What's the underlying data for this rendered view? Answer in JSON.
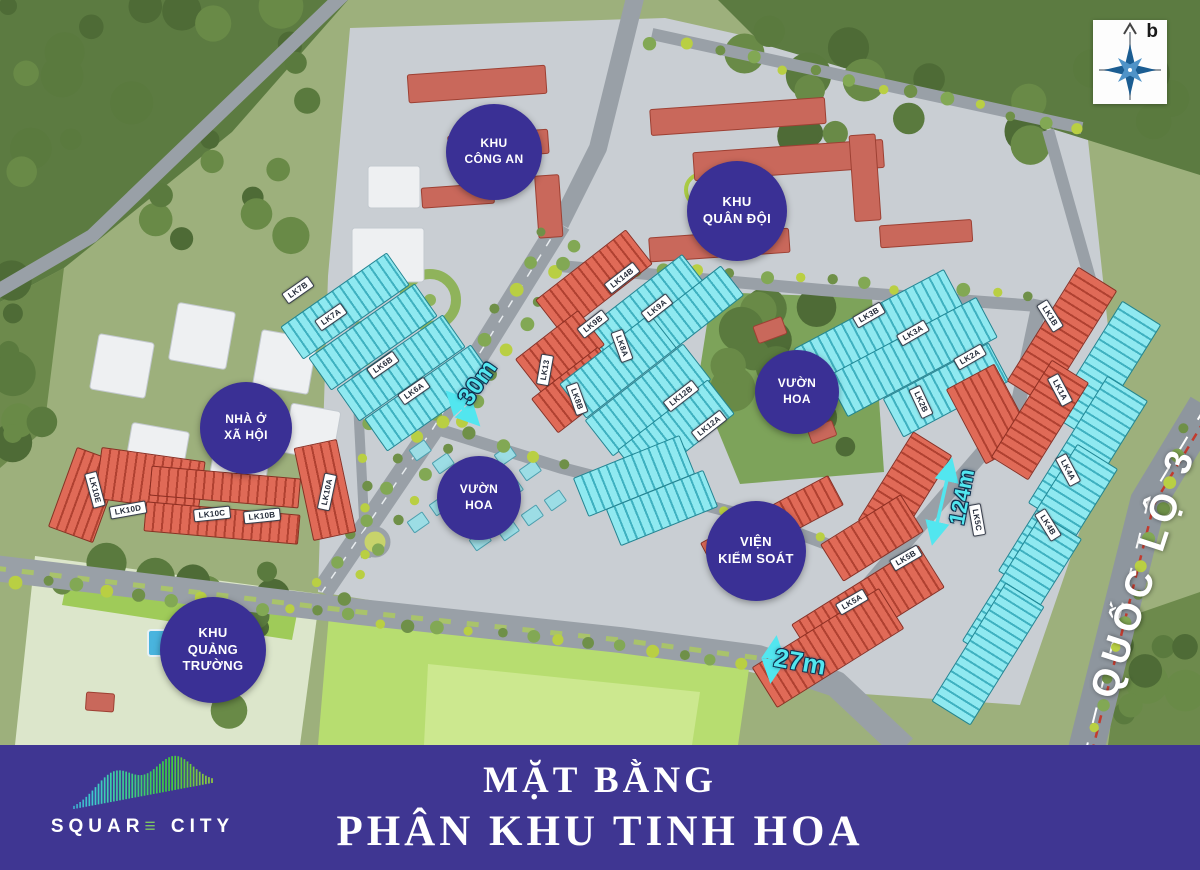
{
  "poster": {
    "banner": {
      "title_line1": "MẶT BẰNG",
      "title_line2": "PHÂN KHU TINH HOA"
    },
    "logo": {
      "name": "SQUARE CITY",
      "before_e": "SQUAR",
      "e_glyph": "≡",
      "after_e": " CITY"
    },
    "compass": {
      "label": "b"
    }
  },
  "map": {
    "colors": {
      "badge": "#3a3095",
      "banner": "#3f3692",
      "cyan_block": "#8fe9f0",
      "red_block": "#e06a57",
      "road_label": "#52e6ef"
    },
    "area_badges": [
      {
        "id": "khu-cong-an",
        "lines": [
          "KHU",
          "CÔNG AN"
        ],
        "x": 494,
        "y": 152,
        "d": 96
      },
      {
        "id": "khu-quan-doi",
        "lines": [
          "KHU",
          "QUÂN ĐỘI"
        ],
        "x": 737,
        "y": 211,
        "d": 100
      },
      {
        "id": "nha-o-xa-hoi",
        "lines": [
          "NHÀ Ở",
          "XÃ HỘI"
        ],
        "x": 246,
        "y": 428,
        "d": 92
      },
      {
        "id": "vuon-hoa-west",
        "lines": [
          "VƯỜN",
          "HOA"
        ],
        "x": 479,
        "y": 498,
        "d": 84
      },
      {
        "id": "vuon-hoa-east",
        "lines": [
          "VƯỜN",
          "HOA"
        ],
        "x": 797,
        "y": 392,
        "d": 84
      },
      {
        "id": "vien-kiem-soat",
        "lines": [
          "VIỆN",
          "KIỂM SOÁT"
        ],
        "x": 756,
        "y": 551,
        "d": 100
      },
      {
        "id": "khu-quang-truong",
        "lines": [
          "KHU",
          "QUẢNG",
          "TRƯỜNG"
        ],
        "x": 213,
        "y": 650,
        "d": 106
      }
    ],
    "road_labels": [
      {
        "id": "road-30m",
        "text": "30m",
        "x": 478,
        "y": 383,
        "rot": -55,
        "size": 24,
        "style": "cyan"
      },
      {
        "id": "road-27m",
        "text": "27m",
        "x": 800,
        "y": 662,
        "rot": 10,
        "size": 26,
        "style": "cyan"
      },
      {
        "id": "road-124m",
        "text": "124m",
        "x": 962,
        "y": 497,
        "rot": -79,
        "size": 22,
        "style": "cyan"
      },
      {
        "id": "highway-quoc-lo-3",
        "text": "QUỐC LỘ 3",
        "x": 1144,
        "y": 572,
        "rot": -72,
        "size": 38,
        "style": "white"
      }
    ],
    "block_labels": [
      {
        "code": "LK10E",
        "x": 95,
        "y": 490,
        "rot": 75
      },
      {
        "code": "LK10D",
        "x": 128,
        "y": 510,
        "rot": -10
      },
      {
        "code": "LK10C",
        "x": 212,
        "y": 514,
        "rot": -6
      },
      {
        "code": "LK10B",
        "x": 262,
        "y": 516,
        "rot": -6
      },
      {
        "code": "LK10A",
        "x": 327,
        "y": 492,
        "rot": -78
      },
      {
        "code": "LK7B",
        "x": 298,
        "y": 290,
        "rot": -35
      },
      {
        "code": "LK7A",
        "x": 331,
        "y": 317,
        "rot": -35
      },
      {
        "code": "LK6B",
        "x": 383,
        "y": 365,
        "rot": -35
      },
      {
        "code": "LK6A",
        "x": 414,
        "y": 391,
        "rot": -35
      },
      {
        "code": "LK9B",
        "x": 593,
        "y": 324,
        "rot": -38
      },
      {
        "code": "LK9A",
        "x": 657,
        "y": 308,
        "rot": -38
      },
      {
        "code": "LK14B",
        "x": 622,
        "y": 278,
        "rot": -38
      },
      {
        "code": "LK13",
        "x": 545,
        "y": 370,
        "rot": -80
      },
      {
        "code": "LK8A",
        "x": 622,
        "y": 346,
        "rot": 70
      },
      {
        "code": "LK8B",
        "x": 577,
        "y": 399,
        "rot": 70
      },
      {
        "code": "LK12B",
        "x": 681,
        "y": 396,
        "rot": -38
      },
      {
        "code": "LK12A",
        "x": 709,
        "y": 426,
        "rot": -38
      },
      {
        "code": "LK3B",
        "x": 869,
        "y": 315,
        "rot": -30
      },
      {
        "code": "LK3A",
        "x": 913,
        "y": 333,
        "rot": -30
      },
      {
        "code": "LK2A",
        "x": 970,
        "y": 357,
        "rot": -30
      },
      {
        "code": "LK2B",
        "x": 921,
        "y": 402,
        "rot": 65
      },
      {
        "code": "LK1B",
        "x": 1050,
        "y": 316,
        "rot": 58
      },
      {
        "code": "LK1A",
        "x": 1060,
        "y": 390,
        "rot": 62
      },
      {
        "code": "LK4A",
        "x": 1068,
        "y": 470,
        "rot": 62
      },
      {
        "code": "LK4B",
        "x": 1048,
        "y": 525,
        "rot": 58
      },
      {
        "code": "LK5C",
        "x": 977,
        "y": 520,
        "rot": 80
      },
      {
        "code": "LK5B",
        "x": 906,
        "y": 558,
        "rot": -30
      },
      {
        "code": "LK5A",
        "x": 852,
        "y": 602,
        "rot": -30
      }
    ]
  }
}
